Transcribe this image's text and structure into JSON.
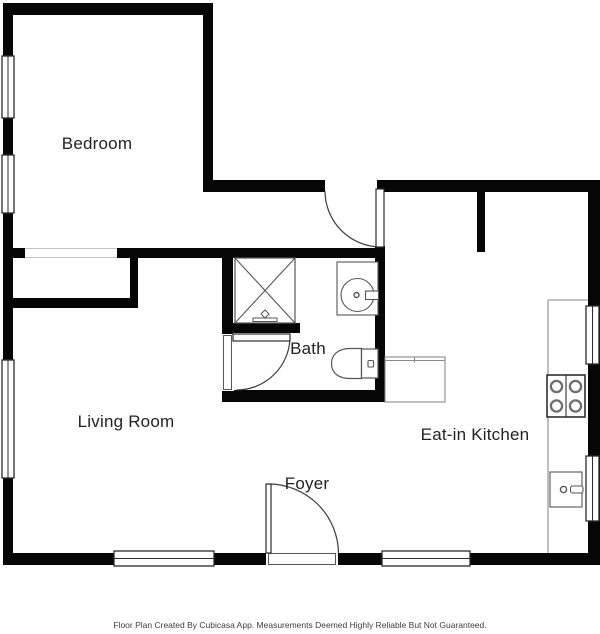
{
  "title": "Floor Plan",
  "footer": {
    "text": "Floor Plan Created By Cubicasa App. Measurements Deemed Highly Reliable But Not Guaranteed."
  },
  "colors": {
    "wall": "#060606",
    "window_frame": "#2b2b2b",
    "door_line": "#3c3c3c",
    "fixture_line": "#565656",
    "counter_line": "#8a8a8a",
    "cased_opening_line": "#c4c4c4",
    "label_text": "#222222",
    "footer_text": "#3d3d3d",
    "background": "#ffffff"
  },
  "rooms": [
    {
      "name": "bedroom",
      "label": "Bedroom",
      "x": 97,
      "y": 144
    },
    {
      "name": "living-room",
      "label": "Living Room",
      "x": 126,
      "y": 422
    },
    {
      "name": "bath",
      "label": "Bath",
      "x": 308,
      "y": 349
    },
    {
      "name": "foyer",
      "label": "Foyer",
      "x": 307,
      "y": 484
    },
    {
      "name": "eat-in-kitchen",
      "label": "Eat-in Kitchen",
      "x": 475,
      "y": 435
    }
  ],
  "plan": {
    "canvas": {
      "w": 600,
      "h": 634
    },
    "walls": [
      {
        "name": "exterior-top",
        "x": 3,
        "y": 3,
        "w": 210,
        "h": 12
      },
      {
        "name": "exterior-left",
        "x": 3,
        "y": 3,
        "w": 10,
        "h": 562
      },
      {
        "name": "bedroom-right",
        "x": 203,
        "y": 3,
        "w": 10,
        "h": 188
      },
      {
        "name": "upper-horizontal",
        "x": 203,
        "y": 180,
        "w": 397,
        "h": 12
      },
      {
        "name": "exterior-right",
        "x": 588,
        "y": 180,
        "w": 12,
        "h": 385
      },
      {
        "name": "exterior-bottom",
        "x": 3,
        "y": 553,
        "w": 597,
        "h": 12
      },
      {
        "name": "bedroom-bottom",
        "x": 3,
        "y": 248,
        "w": 382,
        "h": 10
      },
      {
        "name": "closet-stub",
        "x": 130,
        "y": 258,
        "w": 8,
        "h": 40
      },
      {
        "name": "closet-bottom",
        "x": 3,
        "y": 298,
        "w": 135,
        "h": 10
      },
      {
        "name": "bath-left",
        "x": 222,
        "y": 248,
        "w": 11,
        "h": 154
      },
      {
        "name": "bath-right",
        "x": 375,
        "y": 246,
        "w": 10,
        "h": 156
      },
      {
        "name": "bath-bottom",
        "x": 222,
        "y": 390,
        "w": 163,
        "h": 12
      },
      {
        "name": "shower-bottom",
        "x": 222,
        "y": 323,
        "w": 78,
        "h": 10
      },
      {
        "name": "kitchen-stub",
        "x": 477,
        "y": 191,
        "w": 8,
        "h": 61
      }
    ],
    "openings": [
      {
        "name": "bedroom-closet-opening",
        "kind": "cased",
        "x": 25,
        "y": 247,
        "w": 92,
        "h": 12
      },
      {
        "name": "entry-door-gap",
        "kind": "gap",
        "x": 325,
        "y": 179,
        "w": 52,
        "h": 14
      },
      {
        "name": "bath-door-gap",
        "kind": "jamb",
        "x": 221,
        "y": 334,
        "w": 13,
        "h": 57
      },
      {
        "name": "foyer-door-gap",
        "kind": "jamb",
        "x": 266,
        "y": 552,
        "w": 72,
        "h": 14
      }
    ],
    "windows": [
      {
        "name": "bedroom-window-1",
        "x": 2,
        "y": 56,
        "w": 12,
        "h": 62,
        "axis": "v"
      },
      {
        "name": "bedroom-window-2",
        "x": 2,
        "y": 155,
        "w": 12,
        "h": 58,
        "axis": "v"
      },
      {
        "name": "living-room-window",
        "x": 2,
        "y": 360,
        "w": 12,
        "h": 118,
        "axis": "v"
      },
      {
        "name": "bottom-window-left",
        "x": 114,
        "y": 551,
        "w": 100,
        "h": 15,
        "axis": "h"
      },
      {
        "name": "bottom-window-right",
        "x": 382,
        "y": 551,
        "w": 88,
        "h": 15,
        "axis": "h"
      },
      {
        "name": "kitchen-window-upper",
        "x": 586,
        "y": 306,
        "w": 13,
        "h": 58,
        "axis": "v"
      },
      {
        "name": "kitchen-window-lower",
        "x": 586,
        "y": 456,
        "w": 13,
        "h": 65,
        "axis": "v"
      }
    ],
    "doors": [
      {
        "name": "entry-door",
        "leaf": {
          "x": 376,
          "y": 189,
          "w": 8,
          "h": 58
        },
        "arc": "M325,191 A56,56 0 0 0 381,247"
      },
      {
        "name": "bath-door",
        "leaf": {
          "x": 233,
          "y": 334,
          "w": 57,
          "h": 7
        },
        "arc": "M290,337 A53.5,53.5 0 0 1 236.5,390"
      },
      {
        "name": "foyer-door",
        "leaf": {
          "x": 266,
          "y": 484,
          "w": 5,
          "h": 69
        },
        "arc": "M268.5,484 A70,70 0 0 1 338.5,554"
      }
    ],
    "fixtures": [
      {
        "type": "shower",
        "name": "shower",
        "x": 235,
        "y": 258,
        "w": 60,
        "h": 65
      },
      {
        "type": "shower-faucet",
        "name": "shower-faucet",
        "x": 253,
        "y": 311,
        "w": 24,
        "h": 10
      },
      {
        "type": "round-sink",
        "name": "bath-sink",
        "x": 337,
        "y": 262,
        "w": 41,
        "h": 53,
        "cx": 357.5,
        "cy": 295,
        "r": 16.5,
        "fx": 365.5,
        "fy": 291,
        "fw": 13,
        "fh": 8.5
      },
      {
        "type": "toilet",
        "name": "toilet",
        "tank": {
          "x": 361.5,
          "y": 349,
          "w": 16.5,
          "h": 29
        },
        "bowl": "M361.5,348.5 H350 C338,348.5 331.5,355 331.5,363.5 C331.5,372.5 338,378.5 350,378.5 H361.5 Z",
        "button": {
          "x": 368,
          "y": 360.5,
          "w": 5.5,
          "h": 6.5
        }
      },
      {
        "type": "counter",
        "name": "kitchen-peninsula",
        "x": 385,
        "y": 357,
        "w": 60,
        "h": 45
      },
      {
        "type": "counter-edge",
        "name": "kitchen-counter",
        "x": 548,
        "y": 300,
        "w": 40,
        "h": 253
      },
      {
        "type": "stove",
        "name": "stove",
        "x": 547,
        "y": 375,
        "w": 38,
        "h": 42
      },
      {
        "type": "square-sink",
        "name": "kitchen-sink",
        "x": 550,
        "y": 472,
        "w": 32,
        "h": 35
      }
    ]
  }
}
